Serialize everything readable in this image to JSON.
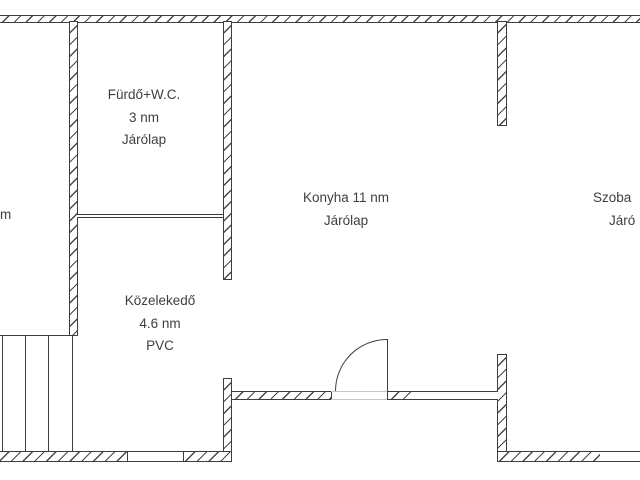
{
  "page": {
    "type": "floor-plan",
    "background": "#ffffff"
  },
  "palette": {
    "wall_line": "#3d3d3d",
    "hatch_line": "#3e3e3e",
    "threshold": "#c6c6c6",
    "text": "#3f3f3f"
  },
  "labels": {
    "left_room": {
      "line1": "m"
    },
    "bathroom": {
      "line1": "Fürdő+W.C.",
      "line2": "3 nm",
      "line3": "Járólap"
    },
    "kitchen": {
      "line1": "Konyha 11 nm",
      "line2": "Járólap"
    },
    "hallway": {
      "line1": "Közelekedő",
      "line2": "4.6 nm",
      "line3": "PVC"
    },
    "right_room": {
      "line1": "Szoba",
      "line2": "Járó"
    }
  }
}
